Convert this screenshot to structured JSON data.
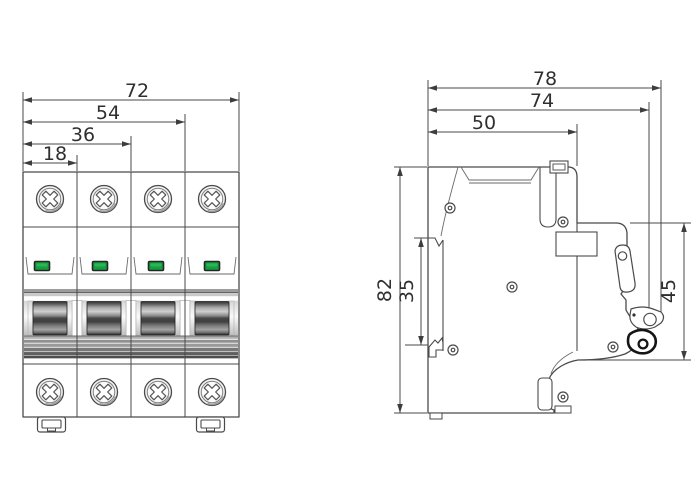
{
  "front_view": {
    "dims": {
      "overall_width": "72",
      "three_pole_width": "54",
      "two_pole_width": "36",
      "one_pole_width": "18"
    }
  },
  "side_view": {
    "dims": {
      "overall_depth": "78",
      "depth_to_latch": "74",
      "body_depth": "50",
      "overall_height": "82",
      "rail_opening_height": "35",
      "front_section_height": "45"
    }
  },
  "colors": {
    "line": "#4a4a4a",
    "indicator_green": "#149f3d",
    "toggle_dark": "#2e2e2e",
    "background": "#ffffff"
  }
}
